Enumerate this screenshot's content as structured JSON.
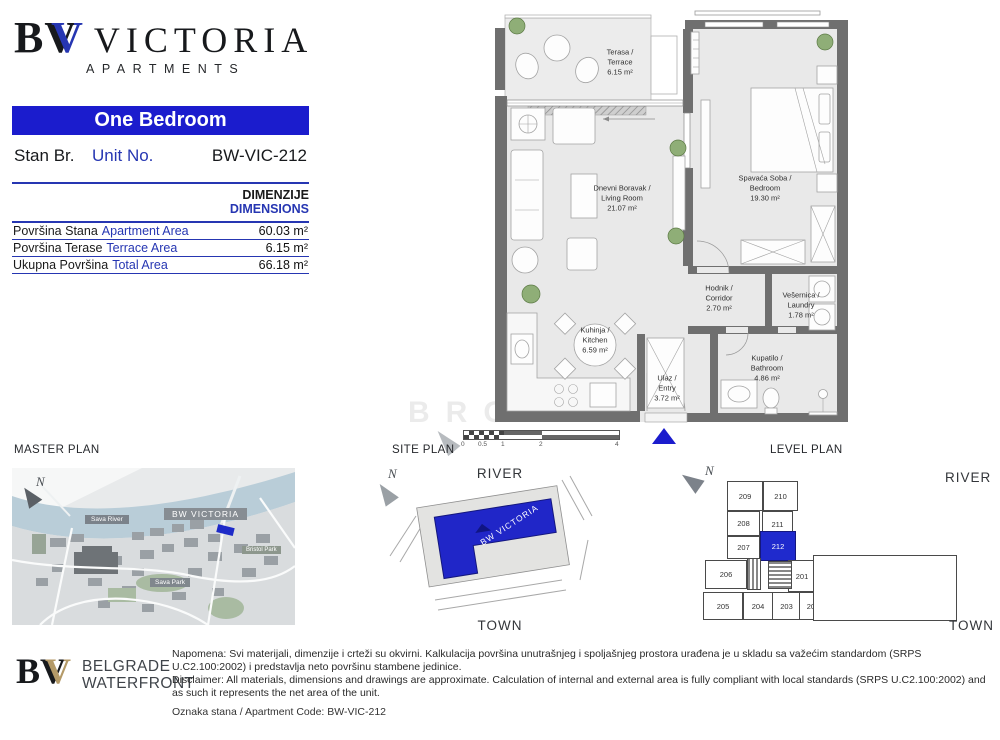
{
  "brand": {
    "logo_b": "B",
    "logo_v_black": "V",
    "logo_v_blue": "V",
    "name": "VICTORIA",
    "subtitle": "APARTMENTS"
  },
  "header": {
    "unit_type": "One Bedroom",
    "stan_label": "Stan Br.",
    "unit_label": "Unit No.",
    "unit_code": "BW-VIC-212"
  },
  "dimensions": {
    "title_sr": "DIMENZIJE",
    "title_en": "DIMENSIONS",
    "rows": [
      {
        "sr": "Površina Stana",
        "en": "Apartment Area",
        "value": "60.03 m²"
      },
      {
        "sr": "Površina Terase",
        "en": "Terrace Area",
        "value": "6.15 m²"
      },
      {
        "sr": "Ukupna Površina",
        "en": "Total Area",
        "value": "66.18 m²"
      }
    ]
  },
  "floorplan": {
    "rooms": [
      {
        "line1": "Terasa /",
        "line2": "Terrace",
        "area": "6.15 m²"
      },
      {
        "line1": "Dnevni Boravak /",
        "line2": "Living Room",
        "area": "21.07 m²"
      },
      {
        "line1": "Spavaća Soba /",
        "line2": "Bedroom",
        "area": "19.30 m²"
      },
      {
        "line1": "Hodnik /",
        "line2": "Corridor",
        "area": "2.70 m²"
      },
      {
        "line1": "Vešernica /",
        "line2": "Laundry",
        "area": "1.78 m²"
      },
      {
        "line1": "Kuhinja /",
        "line2": "Kitchen",
        "area": "6.59 m²"
      },
      {
        "line1": "Ulaz /",
        "line2": "Entry",
        "area": "3.72 m²"
      },
      {
        "line1": "Kupatilo /",
        "line2": "Bathroom",
        "area": "4.86 m²"
      }
    ],
    "scale_ticks": [
      "0",
      "0.5",
      "1",
      "2",
      "4"
    ],
    "watermark": "BROKER"
  },
  "master_plan": {
    "title": "MASTER PLAN",
    "north": "N",
    "labels": {
      "river": "Sava River",
      "project": "BW VICTORIA",
      "park_right": "Bristol Park",
      "park_bottom": "Sava Park"
    }
  },
  "site_plan": {
    "title": "SITE PLAN",
    "north": "N",
    "river": "RIVER",
    "town": "TOWN",
    "building": "BW VICTORIA"
  },
  "level_plan": {
    "title": "LEVEL PLAN",
    "north": "N",
    "river": "RIVER",
    "town": "TOWN",
    "units": [
      "209",
      "210",
      "208",
      "211",
      "207",
      "212",
      "206",
      "201",
      "205",
      "204",
      "203",
      "202"
    ],
    "highlighted": "212"
  },
  "footer": {
    "logo_b": "B",
    "logo_v_black": "V",
    "logo_v_gold": "V",
    "company_top": "BELGRADE",
    "company_bottom": "WATERFRONT",
    "note_sr": "Napomena: Svi materijali, dimenzije i crteži su okvirni. Kalkulacija površina unutrašnjeg i spoljašnjeg prostora urađena je u skladu sa važećim standardom (SRPS U.C2.100:2002) i predstavlja neto površinu stambene jedinice.",
    "note_en": "Disclaimer: All materials, dimensions and drawings are approximate. Calculation of internal and external area is fully compliant with local standards (SRPS U.C2.100:2002) and as such it represents the net area of the unit.",
    "code_line": "Oznaka stana / Apartment Code: BW-VIC-212"
  },
  "colors": {
    "accent_blue": "#1b1ccd",
    "text_blue": "#2636b2",
    "wall_gray": "#6f6f6f",
    "river_blue": "#b9cdd8",
    "gold": "#b49a68",
    "highlight_unit": "#1f2acd"
  }
}
